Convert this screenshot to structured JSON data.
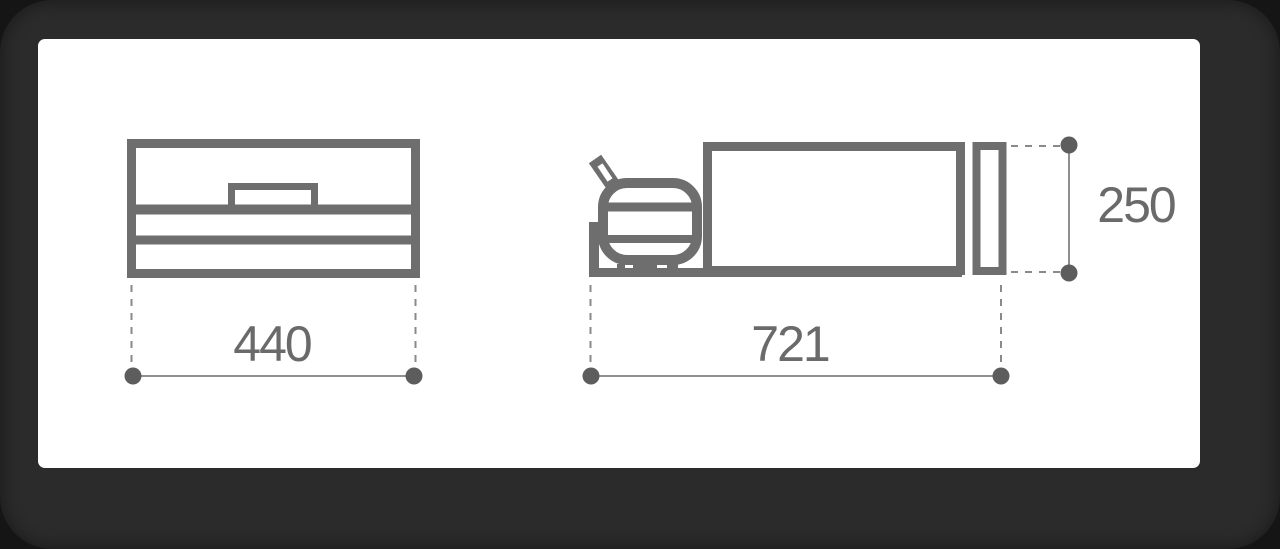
{
  "colors": {
    "line": "#6e6e6e",
    "dim_text": "#6a6a6a",
    "dot": "#5d5d5d",
    "dim_line": "#8f8f8f",
    "dash_line": "#8a8a8a",
    "card_bg": "#ffffff",
    "frame_bg": "#2b2b2b",
    "page_bg": "#151515"
  },
  "diagram": {
    "type": "technical_dimension_drawing",
    "views": [
      {
        "id": "front-view",
        "description": "Front elevation of appliance body with lid handle and two horizontal trim lines",
        "dimension_label": "440"
      },
      {
        "id": "side-view",
        "description": "Side elevation showing gas cylinder on tray shelf, main body and rear door panel",
        "dimension_labels": [
          "721",
          "250"
        ]
      }
    ]
  },
  "dimensions": {
    "width": "440",
    "depth": "721",
    "height": "250"
  }
}
